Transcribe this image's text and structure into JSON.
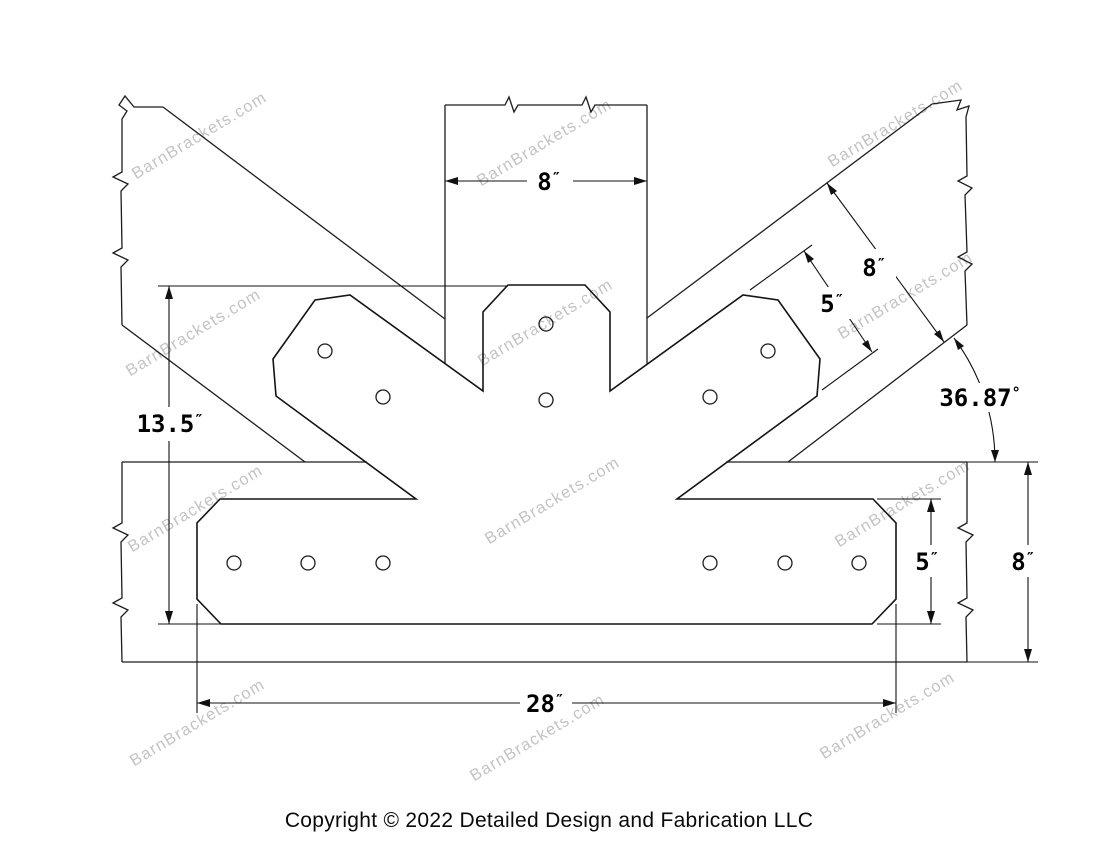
{
  "drawing": {
    "title": "fan-bracket-technical-drawing",
    "dimensions": {
      "post_width": {
        "value": "8",
        "unit": "″"
      },
      "plate_height": {
        "value": "13.5",
        "unit": "″"
      },
      "diag_beam_width": {
        "value": "8",
        "unit": "″"
      },
      "diag_arm_width": {
        "value": "5",
        "unit": "″"
      },
      "angle": {
        "value": "36.87",
        "unit": "°"
      },
      "plate_strip_height": {
        "value": "5",
        "unit": "″"
      },
      "beam_height": {
        "value": "8",
        "unit": "″"
      },
      "plate_length": {
        "value": "28",
        "unit": "″"
      }
    },
    "watermark": {
      "text": "BarnBrackets.com",
      "color": "#b5b5b5"
    },
    "footer": {
      "copyright": "Copyright © 2022 Detailed Design and Fabrication LLC"
    },
    "colors": {
      "line": "#1a1a1a",
      "background": "#ffffff"
    }
  }
}
